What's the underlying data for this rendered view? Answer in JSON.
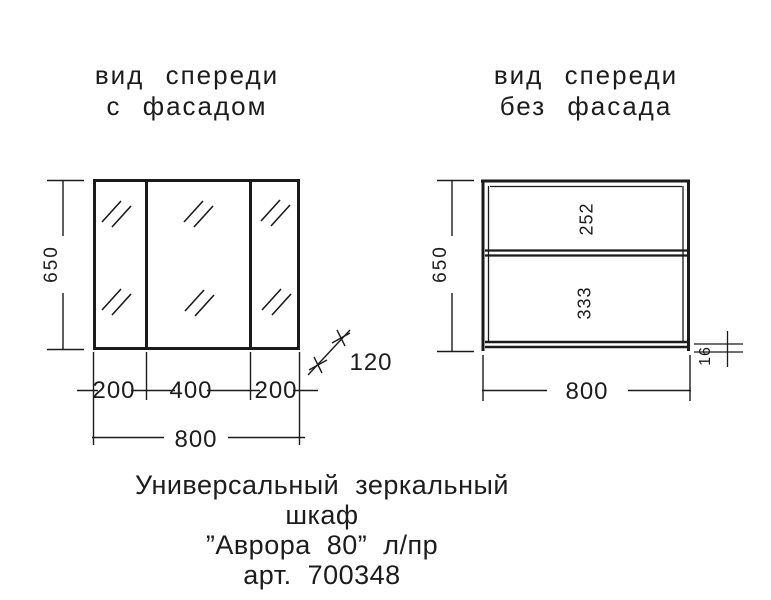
{
  "ink": {
    "line_color": "#1b1b1b",
    "text_color": "#1c1c1c"
  },
  "left_view": {
    "title_line1": "вид спереди",
    "title_line2": "с фасадом",
    "dim_height": "650",
    "dim_door_left": "200",
    "dim_door_middle": "400",
    "dim_door_right": "200",
    "dim_width": "800",
    "dim_depth": "120"
  },
  "right_view": {
    "title_line1": "вид спереди",
    "title_line2": "без фасада",
    "dim_height": "650",
    "dim_top_section": "252",
    "dim_bottom_section": "333",
    "dim_width": "800",
    "dim_bottom_thickness": "16"
  },
  "caption": {
    "line1": "Универсальный зеркальный шкаф",
    "line2": "”Аврора 80” л/пр",
    "line3": "арт. 700348"
  }
}
